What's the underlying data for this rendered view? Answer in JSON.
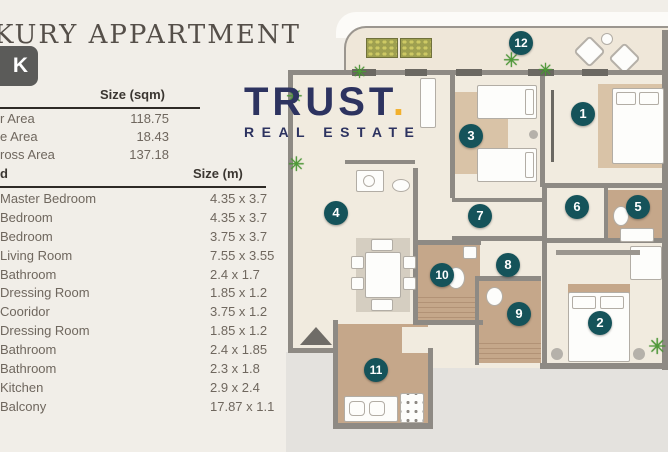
{
  "header": {
    "title": "KURY APPARTMENT",
    "badge": "K"
  },
  "logo": {
    "brand": "TRUST",
    "dot": ".",
    "tagline": "REAL ESTATE"
  },
  "area_table": {
    "size_header": "Size (sqm)",
    "rows": [
      {
        "label": "r Area",
        "value": "118.75"
      },
      {
        "label": "e Area",
        "value": "18.43"
      },
      {
        "label": "ross Area",
        "value": "137.18"
      }
    ]
  },
  "rooms_table": {
    "name_header": "d",
    "size_header": "Size (m)",
    "rows": [
      {
        "label": "Master Bedroom",
        "value": "4.35 x 3.7"
      },
      {
        "label": "Bedroom",
        "value": "4.35 x 3.7"
      },
      {
        "label": "Bedroom",
        "value": "3.75 x 3.7"
      },
      {
        "label": "Living Room",
        "value": "7.55 x 3.55"
      },
      {
        "label": "Bathroom",
        "value": "2.4 x 1.7"
      },
      {
        "label": "Dressing Room",
        "value": "1.85 x 1.2"
      },
      {
        "label": "Cooridor",
        "value": "3.75 x 1.2"
      },
      {
        "label": "Dressing Room",
        "value": "1.85 x 1.2"
      },
      {
        "label": "Bathroom",
        "value": "2.4 x 1.85"
      },
      {
        "label": "Bathroom",
        "value": "2.3 x 1.8"
      },
      {
        "label": "Kitchen",
        "value": "2.9 x 2.4"
      },
      {
        "label": "Balcony",
        "value": "17.87 x 1.1"
      }
    ]
  },
  "floor_plan": {
    "markers": [
      "1",
      "2",
      "3",
      "4",
      "5",
      "6",
      "7",
      "8",
      "9",
      "10",
      "11",
      "12"
    ]
  },
  "icons": {
    "plant": "✳"
  },
  "colors": {
    "marker_teal": "#15535a",
    "wall_gray": "#8e8a84",
    "floor_cream": "#f1ebdf",
    "tile_tan": "#c5a78a",
    "outside_gray": "#e4e2de",
    "plant_green": "#4f9a38",
    "logo_navy": "#2d3360",
    "logo_gold": "#f2b02c",
    "badge_gray": "#5b5b59"
  }
}
